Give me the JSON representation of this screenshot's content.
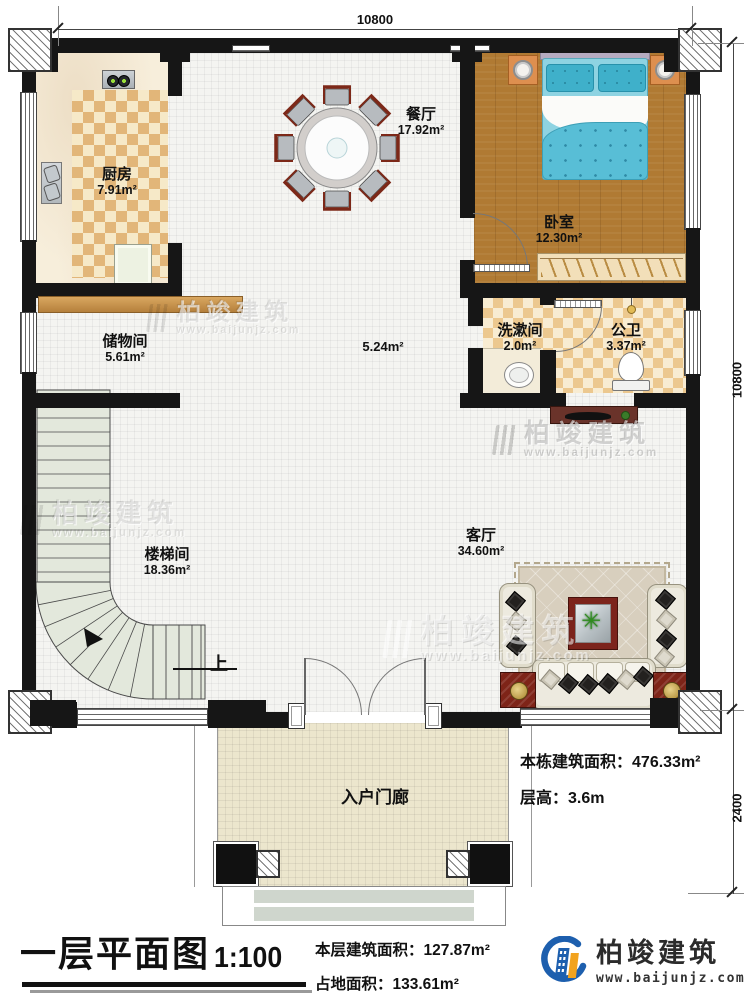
{
  "dimensions": {
    "top": "10800",
    "right_upper": "10800",
    "right_lower": "2400"
  },
  "rooms": {
    "kitchen": {
      "name": "厨房",
      "area": "7.91m²"
    },
    "dining": {
      "name": "餐厅",
      "area": "17.92m²"
    },
    "bedroom": {
      "name": "卧室",
      "area": "12.30m²"
    },
    "storage": {
      "name": "储物间",
      "area": "5.61m²"
    },
    "hallway": {
      "area": "5.24m²"
    },
    "washroom": {
      "name": "洗漱间",
      "area": "2.0m²"
    },
    "toilet": {
      "name": "公卫",
      "area": "3.37m²"
    },
    "stairwell": {
      "name": "楼梯间",
      "area": "18.36m²"
    },
    "living": {
      "name": "客厅",
      "area": "34.60m²"
    },
    "porch": {
      "name": "入户门廊"
    }
  },
  "stairs": {
    "up_label": "上"
  },
  "notes": {
    "building_area_label": "本栋建筑面积：",
    "building_area_value": "476.33m²",
    "floor_height_label": "层高：",
    "floor_height_value": "3.6m"
  },
  "footer": {
    "title": "一层平面图",
    "scale": "1:100",
    "floor_area_label": "本层建筑面积：",
    "floor_area_value": "127.87m²",
    "land_area_label": "占地面积：",
    "land_area_value": "133.61m²"
  },
  "brand": {
    "name": "柏竣建筑",
    "website": "www.baijunjz.com",
    "blue": "#1d5fae",
    "orange": "#f2a31f",
    "text_dark": "#2b2b2b"
  },
  "watermark": {
    "name": "柏竣建筑",
    "website": "www.baijunjz.com"
  }
}
